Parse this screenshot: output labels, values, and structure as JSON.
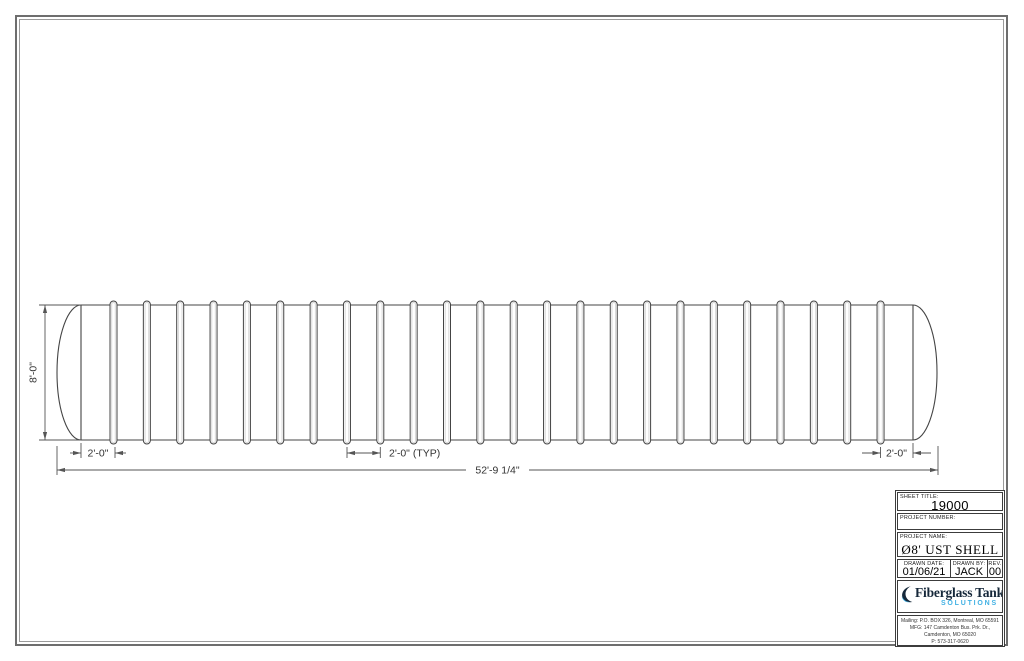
{
  "drawing": {
    "rib_count": 24,
    "rib_first_x": 113.5,
    "rib_spacing": 33.35,
    "dim_labels": {
      "height": "8'-0\"",
      "left_end": "2'-0\"",
      "typ": "2'-0\" (TYP)",
      "overall": "52'-9 1/4\"",
      "right_end": "2'-0\""
    }
  },
  "title_block": {
    "sheet_title_label": "SHEET TITLE:",
    "sheet_title": "19000 GALLONS",
    "project_number_label": "PROJECT NUMBER:",
    "project_name_label": "PROJECT NAME:",
    "project_name": "Ø8' UST SHELL",
    "drawn_date_label": "DRAWN DATE:",
    "drawn_date": "01/06/21",
    "drawn_by_label": "DRAWN BY:",
    "drawn_by": "JACK",
    "rev_label": "REV.",
    "rev": "00",
    "logo": {
      "name": "Fiberglass Tank",
      "tagline": "SOLUTIONS"
    },
    "address": [
      "Mailing: P.O. BOX 326, Montreal, MO 65591",
      "MFG: 147 Camdenton Bus. Prk. Dr.,",
      "Camdenton, MO 65020",
      "P: 573-317-0620"
    ]
  },
  "colors": {
    "line": "#444444",
    "dim": "#555555",
    "border_outer": "#6e6e6e",
    "border_inner": "#9a9a9a",
    "logo_dark": "#16283a",
    "logo_blue": "#41b1e4"
  }
}
